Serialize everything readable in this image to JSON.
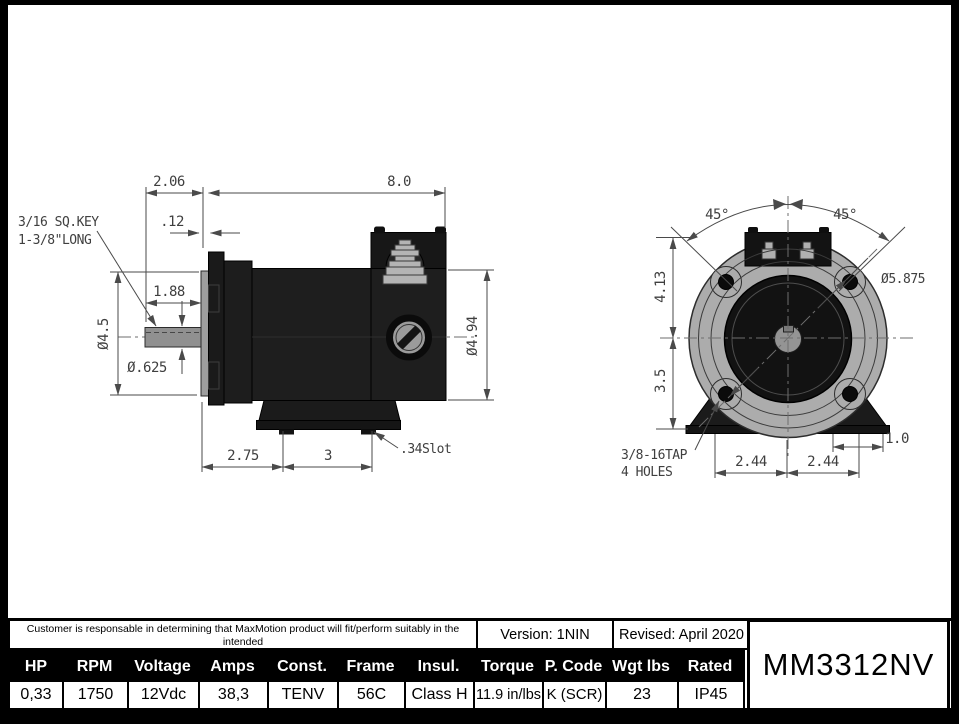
{
  "drawing": {
    "side_view": {
      "key_note_line1": "3/16 SQ.KEY",
      "key_note_line2": "1-3/8\"LONG",
      "dim_shaft_ext": "2.06",
      "dim_body_length": "8.0",
      "dim_flange_offset": ".12",
      "dim_shaft_length": "1.88",
      "dia_flange": "Ø4.5",
      "dia_shaft": "Ø.625",
      "dia_body": "Ø4.94",
      "dim_foot_front": "2.75",
      "dim_foot_span": "3",
      "slot_note": ".34Slot"
    },
    "front_view": {
      "angle_left": "45°",
      "angle_right": "45°",
      "dim_top_to_center": "4.13",
      "dim_center_to_base": "3.5",
      "dia_bolt_circle": "Ø5.875",
      "dim_foot_left": "2.44",
      "dim_foot_right": "2.44",
      "dim_base_edge": "1.0",
      "tap_note_line1": "3/8-16TAP",
      "tap_note_line2": "4 HOLES"
    }
  },
  "title_block": {
    "disclaimer_line1": "Customer is responsable in determining that MaxMotion product will fit/perform suitably in the intended",
    "disclaimer_line2": "application",
    "version": "Version: 1NIN",
    "revised": "Revised: April 2020",
    "model": "MM3312NV",
    "specs": [
      {
        "header": "HP",
        "value": "0,33"
      },
      {
        "header": "RPM",
        "value": "1750"
      },
      {
        "header": "Voltage",
        "value": "12Vdc"
      },
      {
        "header": "Amps",
        "value": "38,3"
      },
      {
        "header": "Const.",
        "value": "TENV"
      },
      {
        "header": "Frame",
        "value": "56C"
      },
      {
        "header": "Insul.",
        "value": "Class H"
      },
      {
        "header": "Torque",
        "value": "11.9 in/lbs"
      },
      {
        "header": "P. Code",
        "value": "K (SCR)"
      },
      {
        "header": "Wgt lbs",
        "value": "23"
      },
      {
        "header": "Rated",
        "value": "IP45"
      }
    ]
  }
}
